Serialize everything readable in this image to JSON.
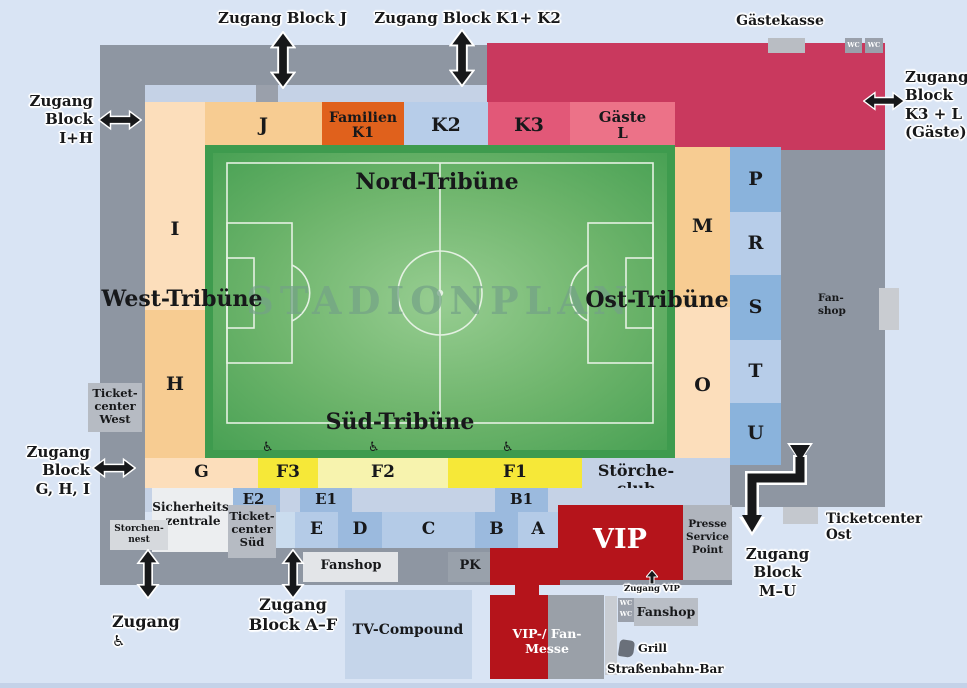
{
  "title": "STADIONPLAN",
  "labels": {
    "zugang_block_j": "Zugang Block J",
    "zugang_block_k1_k2": "Zugang Block K1+ K2",
    "gaestekasse": "Gästekasse",
    "wc": "WC",
    "zugang_block_k3_l": "Zugang\nBlock\nK3 + L\n(Gäste)",
    "zugang_block_i_h": "Zugang\nBlock\nI+H",
    "zugang_block_g_h_i": "Zugang\nBlock\nG, H, I",
    "zugang_barrierefrei": "Zugang",
    "zugang_block_a_f": "Zugang\nBlock A–F",
    "zugang_block_m_u": "Zugang\nBlock\nM–U",
    "zugang_vip": "Zugang VIP",
    "nord_tribuene": "Nord-Tribüne",
    "west_tribuene": "West-Tribüne",
    "ost_tribuene": "Ost-Tribüne",
    "sued_tribuene": "Süd-Tribüne",
    "ticketcenter_west": "Ticket-\ncenter\nWest",
    "ticketcenter_sued": "Ticket-\ncenter\nSüd",
    "ticketcenter_ost": "Ticketcenter\nOst",
    "sicherheitszentrale": "Sicherheits-\nzentrale",
    "storchennest": "Storchen-\nnest",
    "stoercheclub": "Störche-\nclub",
    "fanshop": "Fanshop",
    "fanshop_hyph": "Fan-\nshop",
    "pk": "PK",
    "tv_compound": "TV-Compound",
    "vip": "VIP",
    "vip_fan_messe": "VIP-/ Fan-\nMesse",
    "presse_service_point": "Presse\nService\nPoint",
    "grill": "Grill",
    "strassenbahn_bar": "Straßenbahn-Bar"
  },
  "blocks": {
    "j": "J",
    "familien_k1": "Familien\nK1",
    "k2": "K2",
    "k3": "K3",
    "gaeste_l": "Gäste\nL",
    "i": "I",
    "h": "H",
    "m": "M",
    "o": "O",
    "p": "P",
    "r": "R",
    "s": "S",
    "t": "T",
    "u": "U",
    "g": "G",
    "f3": "F3",
    "f2": "F2",
    "f1": "F1",
    "e2": "E2",
    "e1": "E1",
    "b1": "B1",
    "e": "E",
    "d": "D",
    "c": "C",
    "b": "B",
    "a": "A"
  },
  "icons": {
    "wheelchair": "♿"
  },
  "colors": {
    "background": "#d9e4f4",
    "shell_gray": "#8e96a2",
    "guest_crimson": "#c9395e",
    "k3_rose": "#e25878",
    "gaeste_l_rose": "#ec7288",
    "peach_dark": "#f7cc92",
    "peach_light": "#fcdebb",
    "orange_k1": "#e0611c",
    "blue_light": "#b7cde9",
    "blue_dark": "#8ab3dc",
    "yellow_bright": "#f6e838",
    "yellow_pale": "#f7f3ae",
    "field_green": "#47a053",
    "vip_red": "#b5141b",
    "walkway": "#c5d2e6"
  }
}
